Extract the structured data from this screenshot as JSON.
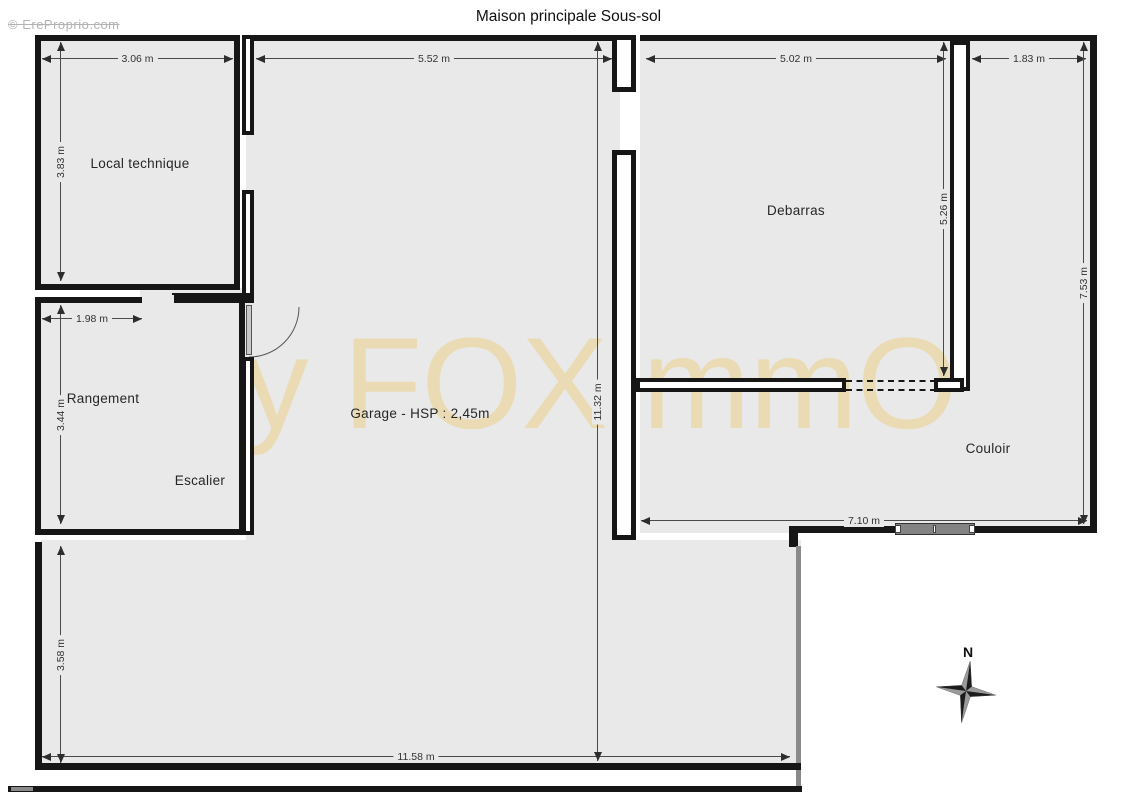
{
  "title": "Maison principale Sous-sol",
  "watermarks": {
    "copyright": "© EreProprio.com",
    "brand": "By FOXImmO"
  },
  "rooms": {
    "local_technique": "Local technique",
    "rangement": "Rangement",
    "escalier": "Escalier",
    "garage": "Garage - HSP : 2,45m",
    "debarras": "Debarras",
    "couloir": "Couloir"
  },
  "dimensions": {
    "local_width": "3.06 m",
    "garage_width": "5.52 m",
    "debarras_width": "5.02 m",
    "couloir_top_width": "1.83 m",
    "local_height": "3.83 m",
    "rangement_door_width": "1.98 m",
    "rangement_height": "3.44 m",
    "garage_height": "11.32 m",
    "debarras_height": "5.26 m",
    "couloir_height": "7.53 m",
    "couloir_width": "7.10 m",
    "bottom_height": "3.58 m",
    "bottom_width": "11.58 m"
  },
  "compass": {
    "north_label": "N"
  },
  "colors": {
    "floor": "#e9e9e9",
    "wall": "#161616",
    "brand_watermark": "#ecd9ac",
    "dimension_line": "#4a4a4a"
  }
}
